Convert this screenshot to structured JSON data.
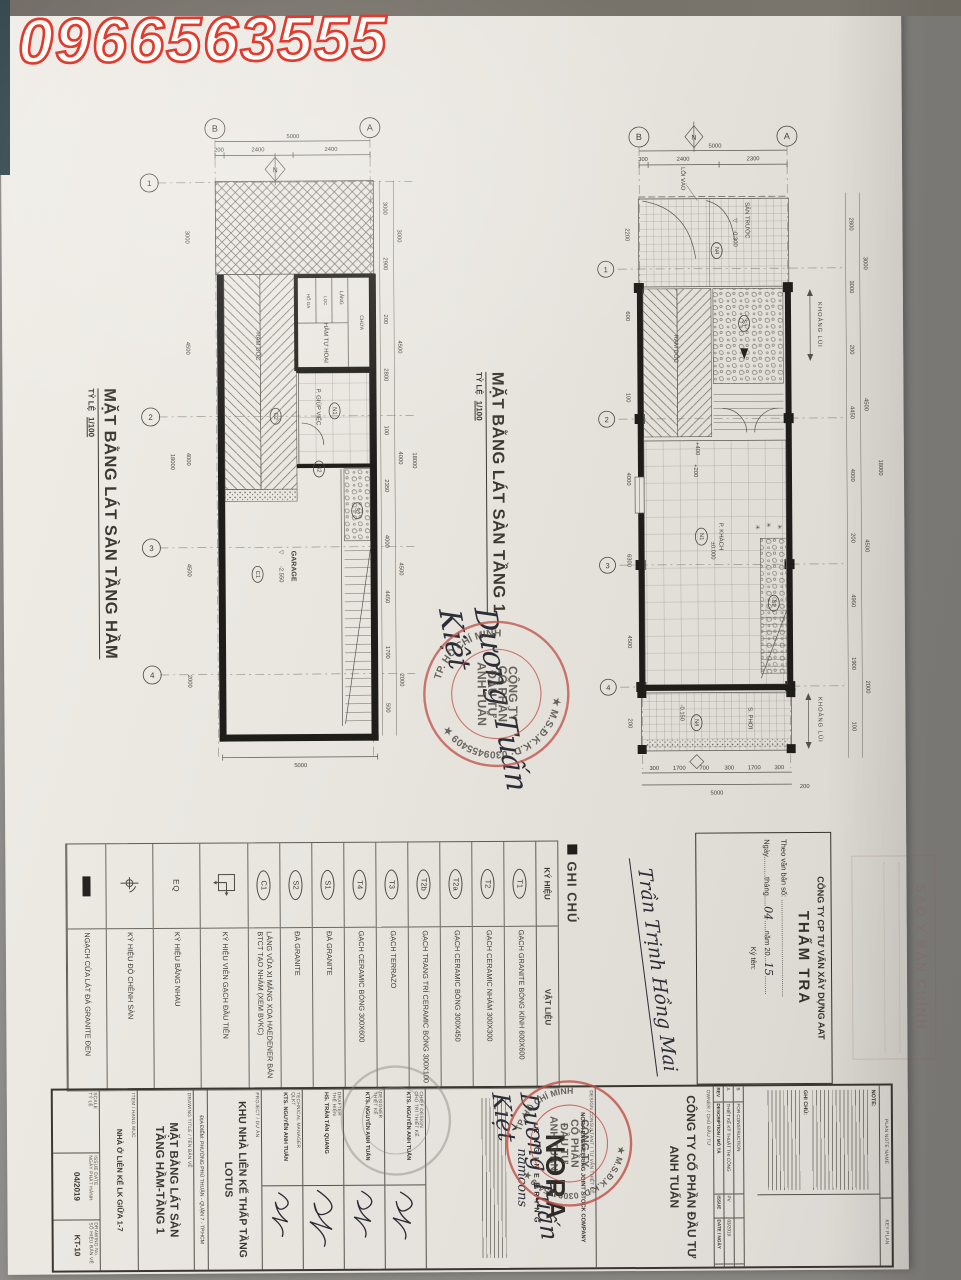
{
  "photo": {
    "phone": "0966563555"
  },
  "glyphs": {
    "level": "▽",
    "north": "N",
    "plant": "✳"
  },
  "plan_basement": {
    "title": "MẶT BẰNG LÁT SÀN TẦNG HẦM",
    "scale_label": "TỶ LỆ",
    "scale": "1/100",
    "grid_top": [
      "B",
      "A"
    ],
    "grid_left": [
      "1",
      "2",
      "3",
      "4"
    ],
    "dim_total_top": "5000",
    "dims_top": [
      "200",
      "2400",
      "2400"
    ],
    "dim_bottom": "5000",
    "dims_left_inner": [
      "3000",
      "4500",
      "4000",
      "4500",
      "2000"
    ],
    "dim_left_total": "18000",
    "dims_right_inner": [
      "3000",
      "2900",
      "200",
      "2800",
      "100",
      "2350",
      "4000",
      "4450",
      "1700",
      "500"
    ],
    "dims_right_mid": [
      "3000",
      "4500",
      "4000",
      "4500",
      "2000"
    ],
    "dim_right_total": "18000",
    "labels": {
      "ramp": "RAM DỐC",
      "ramp_tag": "C2",
      "septic": "HẦM TỰ HOẠI",
      "septic_c1": "HỐ GA",
      "septic_c2": "LỌC",
      "septic_c3": "LẮNG",
      "septic_c4": "CHỨA",
      "maid": "P. GIÚP VIỆC",
      "maid_tag": "N1",
      "door_tag": "S2",
      "stair_tag": "S2",
      "garage": "GARAGE",
      "garage_level": "-2.550",
      "garage_tag": "C1"
    }
  },
  "plan_floor1": {
    "title": "MẶT BẰNG LÁT SÀN TẦNG 1",
    "scale_label": "TỶ LỆ",
    "scale": "1/100",
    "grid_top": [
      "B",
      "A"
    ],
    "grid_left": [
      "1",
      "2",
      "3",
      "4"
    ],
    "dim_total_top": "5000",
    "dims_top": [
      "300",
      "2400",
      "2300"
    ],
    "dim_bottom": "5000",
    "dim_bottom_right": "200",
    "dims_bottom": [
      "300",
      "1700",
      "700",
      "300",
      "1700",
      "300"
    ],
    "dims_left_inner": [
      "2200",
      "600",
      "100",
      "4000",
      "6300",
      "4500",
      "200"
    ],
    "dims_right_inner": [
      "2800",
      "3000",
      "200",
      "4450",
      "4000",
      "200",
      "4950",
      "1900",
      "100"
    ],
    "dims_right_mid": [
      "3000",
      "4500",
      "4500",
      "2000"
    ],
    "dim_right_total": "18000",
    "labels": {
      "entry": "LỐI VÀO",
      "yard": "SÂN TRƯỚC",
      "yard_level": "-0.300",
      "yard_tag": "N4",
      "ramp": "RAM DỐC",
      "stair1_tag": "S1",
      "setback": "KHOẢNG LÙI",
      "lv400": "+400",
      "lv200": "+200",
      "living": "P. KHÁCH",
      "living_tag": "N1",
      "living_level": "±0.000",
      "stair2_tag": "S2",
      "dry": "S. PHƠI",
      "dry_level": "-0.150",
      "dry_tag": "N4",
      "setback2": "KHOẢNG LÙI"
    }
  },
  "legend": {
    "title": "GHI CHÚ",
    "col_symbol": "KÝ HIỆU",
    "col_material": "VẬT LIỆU",
    "rows": [
      {
        "kind": "circle",
        "sym": "T1",
        "desc": "GẠCH GRANITE BÓNG KÍNH 600X600"
      },
      {
        "kind": "circle",
        "sym": "T2",
        "desc": "GẠCH CERAMIC NHÁM 300X300"
      },
      {
        "kind": "circle",
        "sym": "T2a",
        "desc": "GẠCH CERAMIC BÓNG 300X450"
      },
      {
        "kind": "circle",
        "sym": "T2b",
        "desc": "GẠCH TRANG TRÍ CERAMIC BÓNG 300X100"
      },
      {
        "kind": "circle",
        "sym": "T3",
        "desc": "GẠCH TERRAZO"
      },
      {
        "kind": "circle",
        "sym": "T4",
        "desc": "GẠCH CERAMIC BÓNG 300X600"
      },
      {
        "kind": "circle",
        "sym": "S1",
        "desc": "ĐÁ GRANITE"
      },
      {
        "kind": "circle",
        "sym": "S2",
        "desc": "ĐÁ GRANITE"
      },
      {
        "kind": "circle",
        "sym": "C1",
        "desc": "LÁNG VỮA XI MĂNG XOA HAEDENER BẢN BTCT TẠO NHÁM (XEM BVKC)"
      },
      {
        "kind": "square",
        "sym": "",
        "desc": "KÝ HIỆU VIÊN GẠCH ĐẦU TIÊN"
      },
      {
        "kind": "eq",
        "sym": "EQ",
        "desc": "KÝ HIỆU BẰNG NHAU"
      },
      {
        "kind": "level",
        "sym": "",
        "desc": "KÝ HIỆU ĐỘ CHÊNH SÀN"
      },
      {
        "kind": "black",
        "sym": "",
        "desc": "NGẠCH CỬA LÁT ĐÁ GRANITE ĐEN"
      }
    ]
  },
  "tham_tra": {
    "company": "CÔNG TY CP TƯ VẤN XÂY DỰNG AAT",
    "title": "THẨM TRA",
    "line1": "Theo văn bản số: ...............................................",
    "line2a": "Ngày..........tháng.....",
    "month": "04",
    "line2b": ".....năm 20...",
    "year": "15",
    "sign_label": "Ký tên:"
  },
  "signatures": {
    "approver": "Trần Trịnh Hồng Mai",
    "director": "Dương Tuấn Kiệt"
  },
  "stamps": {
    "sao_y": "SAO Y BẢN CHÍNH",
    "ring_top": "★ M.S.Đ.K.K.D: 0309455409 ★",
    "ring_bottom": "TP. HỒ CHÍ MINH",
    "center": [
      "CÔNG TY",
      "CỔ PHẦN",
      "ĐẦU TƯ",
      "ANH TUẤN"
    ]
  },
  "titleblock": {
    "plan_note_name": "PLAN NOTE NAME",
    "key_plan": "KEY PLAN",
    "note": "NOTE:",
    "ghi_chu": "GHI CHÚ:",
    "rev_headers": [
      "REV",
      "DESCRIPTION / MÔ TẢ",
      "ISSUE",
      "DATE / NGÀY"
    ],
    "rev_rows": [
      {
        "rev": "B",
        "desc": "FOR CONSTRUCTION",
        "issue": "",
        "date": ""
      },
      {
        "rev": "A",
        "desc": "THIẾT KẾ KỸ THUẬT THI CÔNG",
        "issue": "PV",
        "date": "03/2019"
      }
    ],
    "owner_label": "OWNER / CHỦ ĐẦU TƯ",
    "owner1": "CÔNG TY CỔ PHẦN ĐẦU TƯ",
    "owner2": "ANH TUẤN",
    "consultant_label": "DESIGN CONSULTANT / TƯ VẤN THIẾT KẾ",
    "consultant": "NORA ENGINEERING JOINT STOCK COMPANY",
    "logo": "NORA",
    "logo_sub": "ENGINEERING",
    "logo_script": "namcons",
    "project_label": "PROJECT / DỰ ÁN",
    "project1": "KHU NHÀ LIÊN KẾ THẤP TẦNG",
    "project2": "LOTUS",
    "sign_rows": [
      {
        "en": "CHIEF DESIGN",
        "vn": "CHỦ TRÌ THIẾT KẾ",
        "name": "KTS. NGUYỄN ANH TUẤN"
      },
      {
        "en": "DESIGNER",
        "vn": "THIẾT KẾ",
        "name": "KTS. NGUYỄN ANH TUẤN"
      },
      {
        "en": "DRAFTER",
        "vn": "THỂ HIỆN",
        "name": "HS. TRẦN TẤN QUANG"
      },
      {
        "en": "TECHNICAL MANAGER",
        "vn": "QLKT",
        "name": "KTS. NGUYỄN ANH TUẤN"
      }
    ],
    "location": "ĐỊA ĐIỂM: PHƯỜNG PHÚ THUẬN - QUẬN 7 - TP.HCM",
    "dt_label": "DRAWING TITLE / TÊN BẢN VẼ",
    "dt1": "MẶT BẰNG LÁT SÀN",
    "dt2": "TẦNG HẦM-TẦNG 1",
    "item_label": "ITEM / HẠNG MỤC",
    "item": "NHÀ Ở LIÊN KẾ LK GIỮA 1-7",
    "scale_en": "SCALE",
    "scale_vn": "TỶ LỆ",
    "scale_val": "",
    "issue_en": "ISSUE DATE",
    "issue_vn": "NGÀY PHÁT HÀNH",
    "issue_val": "04/2019",
    "no_en": "DRAWING No.",
    "no_vn": "SỐ HIỆU BẢN VẼ",
    "no_val": "KT-10"
  }
}
